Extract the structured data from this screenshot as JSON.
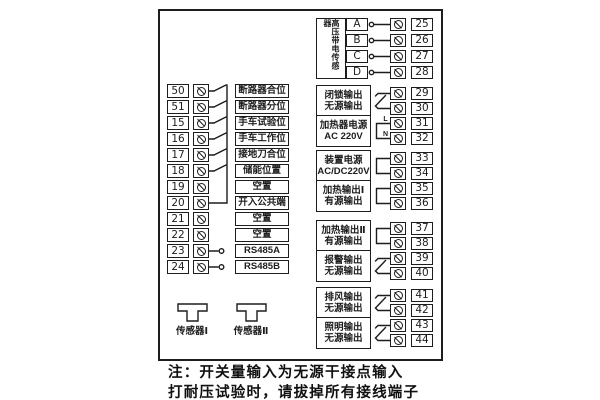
{
  "colors": {
    "ink": "#1d1d1d",
    "background": "#ffffff"
  },
  "diagram": {
    "left_inputs": {
      "rows": [
        {
          "terminal": "50",
          "label": "断路器合位",
          "wire": "switch"
        },
        {
          "terminal": "51",
          "label": "断路器分位",
          "wire": "switch"
        },
        {
          "terminal": "15",
          "label": "手车试验位",
          "wire": "switch"
        },
        {
          "terminal": "16",
          "label": "手车工作位",
          "wire": "switch"
        },
        {
          "terminal": "17",
          "label": "接地刀合位",
          "wire": "switch"
        },
        {
          "terminal": "18",
          "label": "储能位置",
          "wire": "switch"
        },
        {
          "terminal": "19",
          "label": "空置",
          "wire": "none"
        },
        {
          "terminal": "20",
          "label": "开入公共端",
          "wire": "common"
        },
        {
          "terminal": "21",
          "label": "空置",
          "wire": "none"
        },
        {
          "terminal": "22",
          "label": "空置",
          "wire": "none"
        },
        {
          "terminal": "23",
          "label": "RS485A",
          "wire": "stub"
        },
        {
          "terminal": "24",
          "label": "RS485B",
          "wire": "stub"
        }
      ]
    },
    "hv_sensor": {
      "label": "高压带电传感器",
      "channels": [
        {
          "name": "A",
          "terminal": "25"
        },
        {
          "name": "B",
          "terminal": "26"
        },
        {
          "name": "C",
          "terminal": "27"
        },
        {
          "name": "D",
          "terminal": "28"
        }
      ]
    },
    "output_groups": [
      {
        "blocks": [
          {
            "lines": [
              "闭锁输出",
              "无源输出"
            ],
            "symbol": "contact",
            "terminals": [
              "29",
              "30"
            ]
          },
          {
            "lines": [
              "加热器电源",
              "AC 220V"
            ],
            "symbol": "bracket",
            "wire_labels": [
              "L",
              "N"
            ],
            "terminals": [
              "31",
              "32"
            ]
          }
        ]
      },
      {
        "blocks": [
          {
            "lines": [
              "装置电源",
              "AC/DC220V"
            ],
            "symbol": "bracket",
            "terminals": [
              "33",
              "34"
            ]
          },
          {
            "lines": [
              "加热输出Ⅰ",
              "有源输出"
            ],
            "symbol": "bracket",
            "terminals": [
              "35",
              "36"
            ]
          }
        ]
      },
      {
        "blocks": [
          {
            "lines": [
              "加热输出Ⅱ",
              "有源输出"
            ],
            "symbol": "bracket",
            "terminals": [
              "37",
              "38"
            ]
          },
          {
            "lines": [
              "报警输出",
              "无源输出"
            ],
            "symbol": "contact",
            "terminals": [
              "39",
              "40"
            ]
          }
        ]
      },
      {
        "blocks": [
          {
            "lines": [
              "排风输出",
              "无源输出"
            ],
            "symbol": "contact",
            "terminals": [
              "41",
              "42"
            ]
          },
          {
            "lines": [
              "照明输出",
              "无源输出"
            ],
            "symbol": "contact",
            "terminals": [
              "43",
              "44"
            ]
          }
        ]
      }
    ],
    "sensors": [
      {
        "label": "传感器Ⅰ"
      },
      {
        "label": "传感器Ⅱ"
      }
    ],
    "notes": [
      "注：开关量输入为无源干接点输入",
      "打耐压试验时，请拔掉所有接线端子"
    ]
  }
}
